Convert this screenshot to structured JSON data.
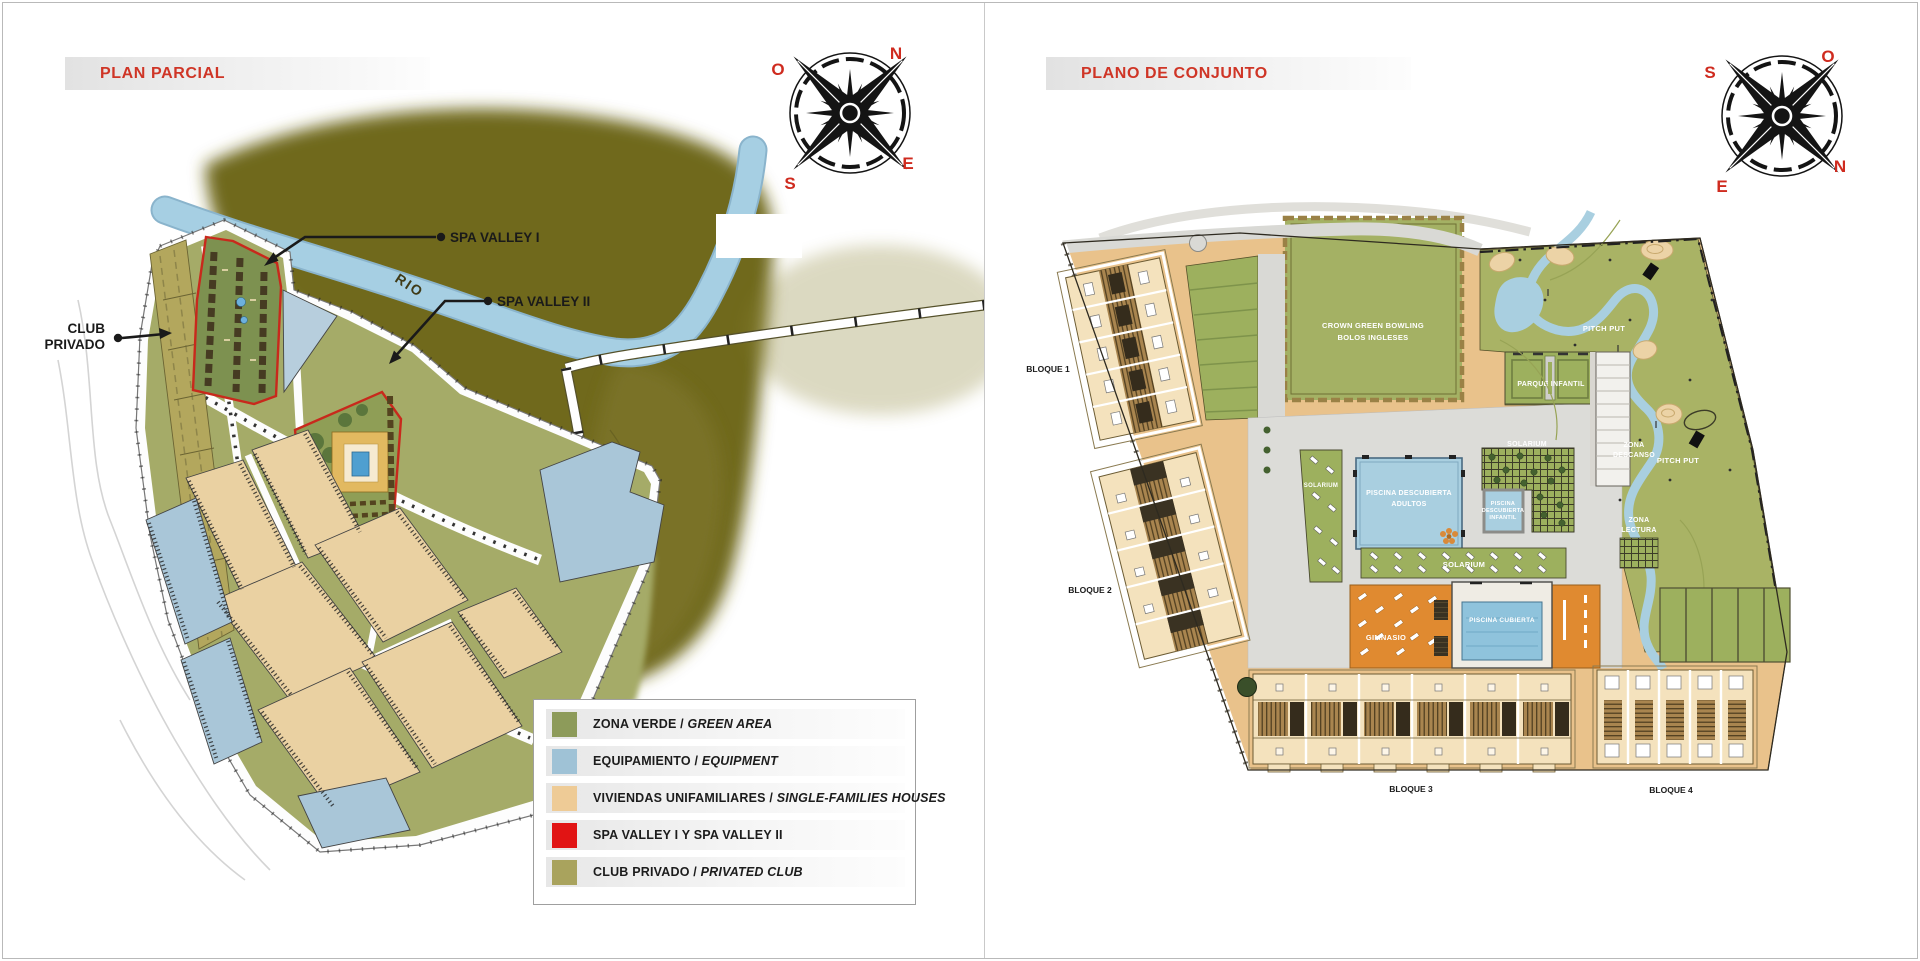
{
  "colors": {
    "accent_red": "#cf3526",
    "legend_green": "#8d9b5a",
    "legend_blue": "#9fc2d6",
    "legend_tan": "#eecb96",
    "legend_red": "#e11414",
    "legend_khaki": "#a9a35d",
    "river_blue": "#a6cfe3",
    "hills_olive": "#6f691f",
    "site_sage": "#a5ab68",
    "right_site_tan": "#e9c28b",
    "pool_blue": "#a9cfe0",
    "gym_orange": "#e08a30"
  },
  "left_panel": {
    "title": "PLAN PARCIAL",
    "compass": {
      "top_left": "O",
      "top_right": "N",
      "bottom_left": "S",
      "bottom_right": "E"
    },
    "map_labels": {
      "spa_valley_1": "SPA VALLEY I",
      "spa_valley_2": "SPA VALLEY II",
      "club_privado_line1": "CLUB",
      "club_privado_line2": "PRIVADO",
      "rio": "RIO"
    },
    "legend": {
      "items": [
        {
          "label": "ZONA VERDE / ",
          "label_italic": "GREEN AREA",
          "color": "#8d9b5a"
        },
        {
          "label": "EQUIPAMIENTO / ",
          "label_italic": "EQUIPMENT",
          "color": "#9fc2d6"
        },
        {
          "label": "VIVIENDAS UNIFAMILIARES / ",
          "label_italic": "SINGLE-FAMILIES HOUSES",
          "color": "#eecb96"
        },
        {
          "label": "SPA VALLEY I Y SPA VALLEY II",
          "label_italic": "",
          "color": "#e11414"
        },
        {
          "label": "CLUB PRIVADO / ",
          "label_italic": "PRIVATED CLUB",
          "color": "#a9a35d"
        }
      ]
    }
  },
  "right_panel": {
    "title": "PLANO DE CONJUNTO",
    "compass": {
      "top_left": "S",
      "top_right": "O",
      "bottom_left": "E",
      "bottom_right": "N"
    },
    "map_labels": {
      "bloque_1": "BLOQUE 1",
      "bloque_2": "BLOQUE 2",
      "bloque_3": "BLOQUE 3",
      "bloque_4": "BLOQUE 4",
      "bowling_line1": "CROWN GREEN BOWLING",
      "bowling_line2": "BOLOS INGLESES",
      "parque_infantil": "PARQUE INFANTIL",
      "pitch_put": "PITCH PUT",
      "piscina_adultos_line1": "PISCINA DESCUBIERTA",
      "piscina_adultos_line2": "ADULTOS",
      "piscina_infantil_line1": "PISCINA",
      "piscina_infantil_line2": "DESCUBIERTA",
      "piscina_infantil_line3": "INFANTIL",
      "solarium": "SOLARIUM",
      "piscina_cubierta": "PISCINA CUBIERTA",
      "gimnasio": "GIMNASIO",
      "zona_descanso_line1": "ZONA",
      "zona_descanso_line2": "DESCANSO",
      "zona_lectura_line1": "ZONA",
      "zona_lectura_line2": "LECTURA"
    }
  }
}
